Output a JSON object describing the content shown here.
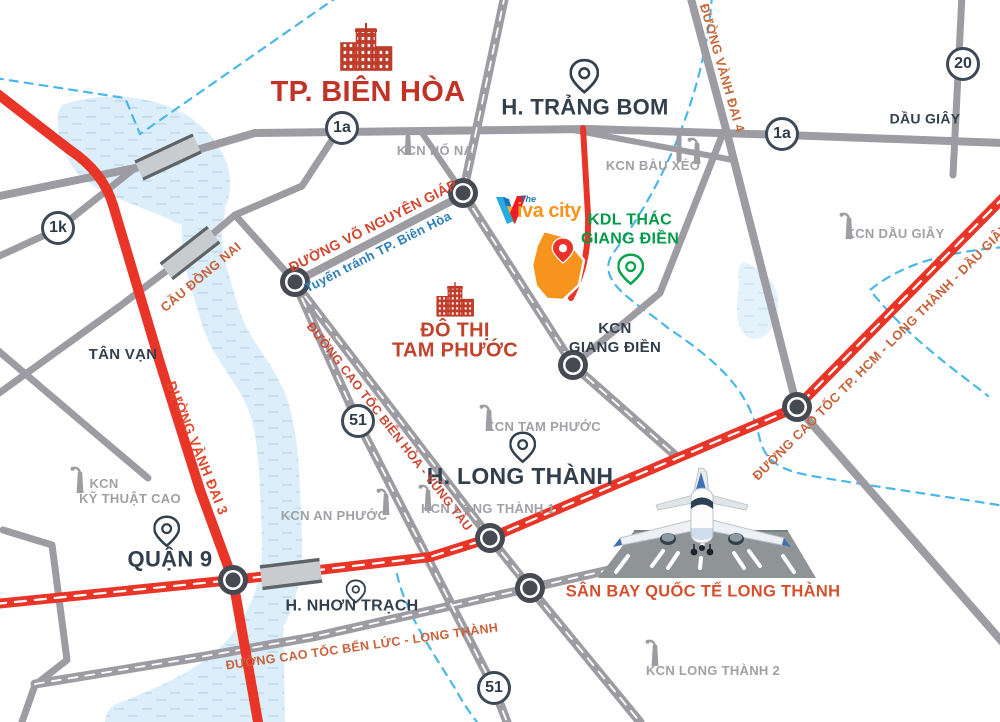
{
  "project": {
    "logo_the": "The",
    "logo_name": "iva city"
  },
  "cities": {
    "tp_bien_hoa": "TP. BIÊN HÒA",
    "h_trang_bom": "H. TRẢNG BOM",
    "dau_giay": "DẦU GIÂY",
    "tan_van": "TÂN VẠN",
    "quan_9": "QUẬN 9",
    "h_long_thanh": "H. LONG THÀNH",
    "h_nhon_trach": "H. NHƠN TRẠCH"
  },
  "districts": {
    "do_thi_line1": "ĐÔ THỊ",
    "do_thi_line2": "TAM PHƯỚC",
    "kcn_giang_dien_line1": "KCN",
    "kcn_giang_dien_line2": "GIANG ĐIỀN",
    "kdl_line1": "KDL THÁC",
    "kdl_line2": "GIANG ĐIỀN"
  },
  "industrial_zones": {
    "ho_nai": "KCN HỐ NAI",
    "bau_xeo": "KCN BÀU XÉO",
    "dau_giay": "KCN DẦU GIÂY",
    "tam_phuoc": "KCN TAM PHƯỚC",
    "an_phuoc": "KCN AN PHƯỚC",
    "long_thanh_1": "KCN LONG THÀNH 1",
    "long_thanh_2": "KCN LONG THÀNH 2",
    "ky_thuat_cao_line1": "KCN",
    "ky_thuat_cao_line2": "KỸ THUẬT CAO"
  },
  "roads": {
    "badges": [
      {
        "label": "1a"
      },
      {
        "label": "1a"
      },
      {
        "label": "1k"
      },
      {
        "label": "20"
      },
      {
        "label": "51"
      },
      {
        "label": "51"
      }
    ],
    "names": {
      "vo_nguyen_giap": "ĐƯỜNG VÕ NGUYÊN GIÁP",
      "tuyen_tranh": "Tuyến tránh TP. Biên Hòa",
      "cau_dong_nai": "CẦU ĐỒNG NAI",
      "vanh_dai_3": "ĐƯỜNG VÀNH ĐAI 3",
      "vanh_dai_4": "ĐƯỜNG VÀNH ĐAI 4",
      "bien_hoa_vung_tau": "ĐƯỜNG CAO TỐC BIÊN HÒA - VŨNG TÀU",
      "ben_luc_long_thanh": "ĐƯỜNG CAO TỐC BẾN LỨC - LONG THÀNH",
      "hcm_long_thanh_dau_giay": "ĐƯỜNG CAO TỐC TP. HCM - LONG THÀNH - DẦU GIÂY"
    }
  },
  "airport": {
    "name": "SÂN BAY QUỐC TẾ LONG THÀNH"
  },
  "colors": {
    "highway_red": "#e93528",
    "road_grey": "#9c9ca2",
    "label_dark": "#32404d",
    "label_red": "#c13327",
    "road_label_orange": "#c8623a",
    "kcn_grey": "#a0a0a6",
    "green": "#00a44a",
    "logo_orange": "#f7941e",
    "river_blue": "#dbeef9",
    "boundary_blue": "#49b8e8"
  }
}
